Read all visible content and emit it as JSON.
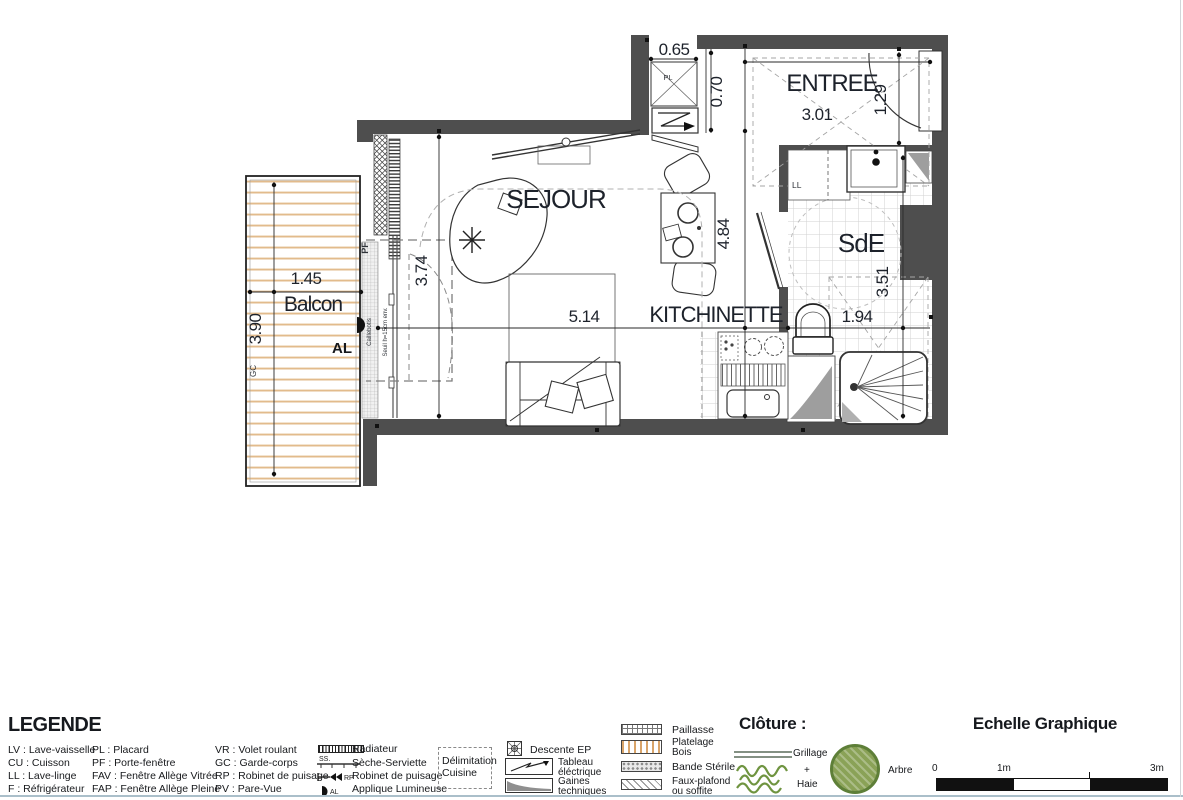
{
  "plan": {
    "labels": {
      "sejour": "SEJOUR",
      "entree": "ENTREE",
      "sde": "SdE",
      "kitchinette": "KITCHINETTE",
      "balcon": "Balcon"
    },
    "dims": {
      "p065": "0.65",
      "p070": "0.70",
      "p301": "3.01",
      "p129": "1.29",
      "p484": "4.84",
      "p351": "3.51",
      "p194": "1.94",
      "p514": "5.14",
      "p374": "3.74",
      "p145": "1.45",
      "p390": "3.90"
    },
    "marks": {
      "al": "AL",
      "pl": "PL",
      "pf": "PF",
      "ll": "LL",
      "gc": "GC",
      "caillebotis": "Caillebotis",
      "seuil": "Seuil h=15cm env."
    }
  },
  "legend": {
    "title": "LEGENDE",
    "col1": [
      "LV : Lave-vaisselle",
      "CU : Cuisson",
      "LL : Lave-linge",
      "F : Réfrigérateur"
    ],
    "col2": [
      "PL : Placard",
      "PF : Porte-fenêtre",
      "FAV : Fenêtre Allège Vitrée",
      "FAP : Fenêtre Allège Pleine"
    ],
    "col3": [
      "VR : Volet roulant",
      "GC : Garde-corps",
      "RP : Robinet de puisage",
      "PV : Pare-Vue"
    ],
    "col4": {
      "radiateur": "Radiateur",
      "ss_tag": "SS.",
      "seche": "Sèche-Serviette",
      "rp_tag": "RP",
      "robinet": "Robinet de puisage",
      "al_tag": "AL",
      "applique": "Applique Lumineuse"
    },
    "delimitation": [
      "Délimitation",
      "Cuisine"
    ],
    "col6": {
      "descente": "Descente EP",
      "tableau": [
        "Tableau",
        "éléctrique"
      ],
      "gaines": [
        "Gaines",
        "techniques"
      ]
    },
    "col7": {
      "paillasse": "Paillasse",
      "platelage": [
        "Platelage",
        "Bois"
      ],
      "bande": "Bande Stérile",
      "fauxplafond": [
        "Faux-plafond",
        "ou soffite"
      ]
    }
  },
  "cloture": {
    "title": "Clôture :",
    "grillage": "Grillage",
    "plus": "+",
    "haie": "Haie",
    "arbre": "Arbre"
  },
  "echelle": {
    "title": "Echelle Graphique",
    "t0": "0",
    "t1": "1m",
    "t3": "3m"
  },
  "colors": {
    "wall": "#4e4e4e",
    "deck": "#e2bb8c",
    "green": "#6f9440",
    "tile": "#d2d2d2"
  }
}
